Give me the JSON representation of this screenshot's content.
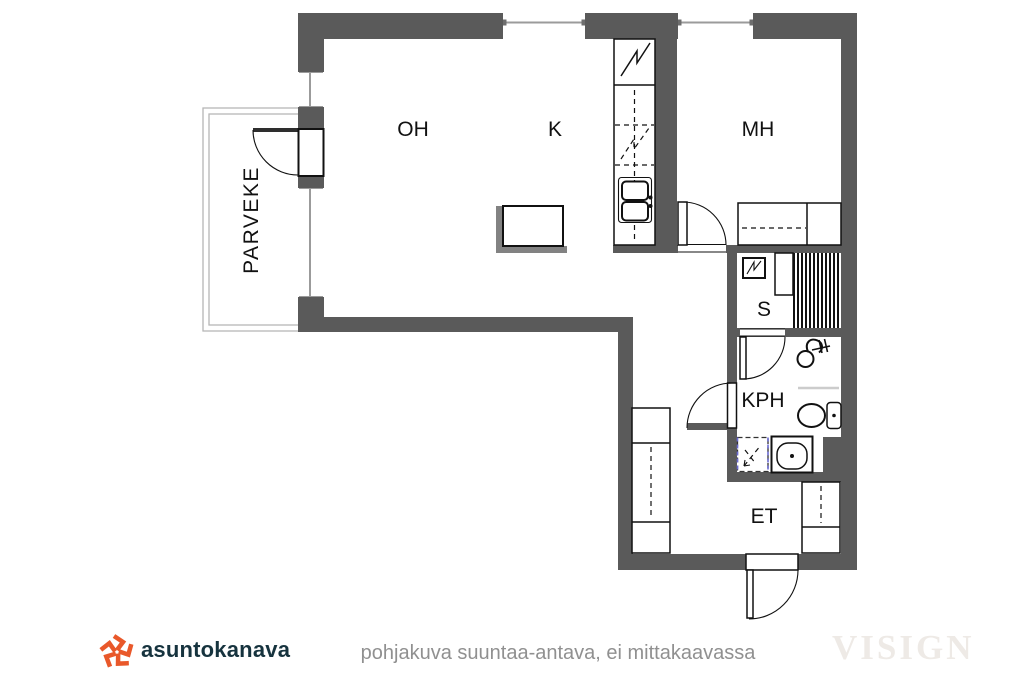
{
  "rooms": [
    {
      "id": "OH",
      "label": "OH",
      "meaning": "living-room"
    },
    {
      "id": "K",
      "label": "K",
      "meaning": "kitchen"
    },
    {
      "id": "MH",
      "label": "MH",
      "meaning": "bedroom"
    },
    {
      "id": "S",
      "label": "S",
      "meaning": "sauna"
    },
    {
      "id": "KPH",
      "label": "KPH",
      "meaning": "bathroom"
    },
    {
      "id": "ET",
      "label": "ET",
      "meaning": "entry-hall"
    },
    {
      "id": "PARVEKE",
      "label": "PARVEKE",
      "meaning": "balcony"
    }
  ],
  "footer": {
    "logo_text": "asuntokanava",
    "disclaimer": "pohjakuva suuntaa-antava, ei mittakaavassa",
    "watermark": "VISIGN"
  },
  "icons": [
    "window-icon",
    "balcony-door-icon",
    "room-door-icon",
    "entry-door-icon",
    "refrigerator-icon",
    "dishwasher-icon",
    "kitchen-sink-icon",
    "kitchen-island-icon",
    "bed-icon",
    "sauna-stove-icon",
    "sauna-bench-icon",
    "shower-icon",
    "toilet-icon",
    "washing-machine-icon",
    "bathroom-sink-icon",
    "wardrobe-icon",
    "logo-pinwheel-icon"
  ],
  "colors": {
    "wall": "#5a5a5a",
    "glass": "#9b9b9b",
    "balcony": "#b5b5b5",
    "shadow": "#828282",
    "washer": "#6a6ad0",
    "accent": "#e9582a",
    "logo-text": "#16333e",
    "muted": "#909090",
    "watermark": "#eeeae6"
  }
}
